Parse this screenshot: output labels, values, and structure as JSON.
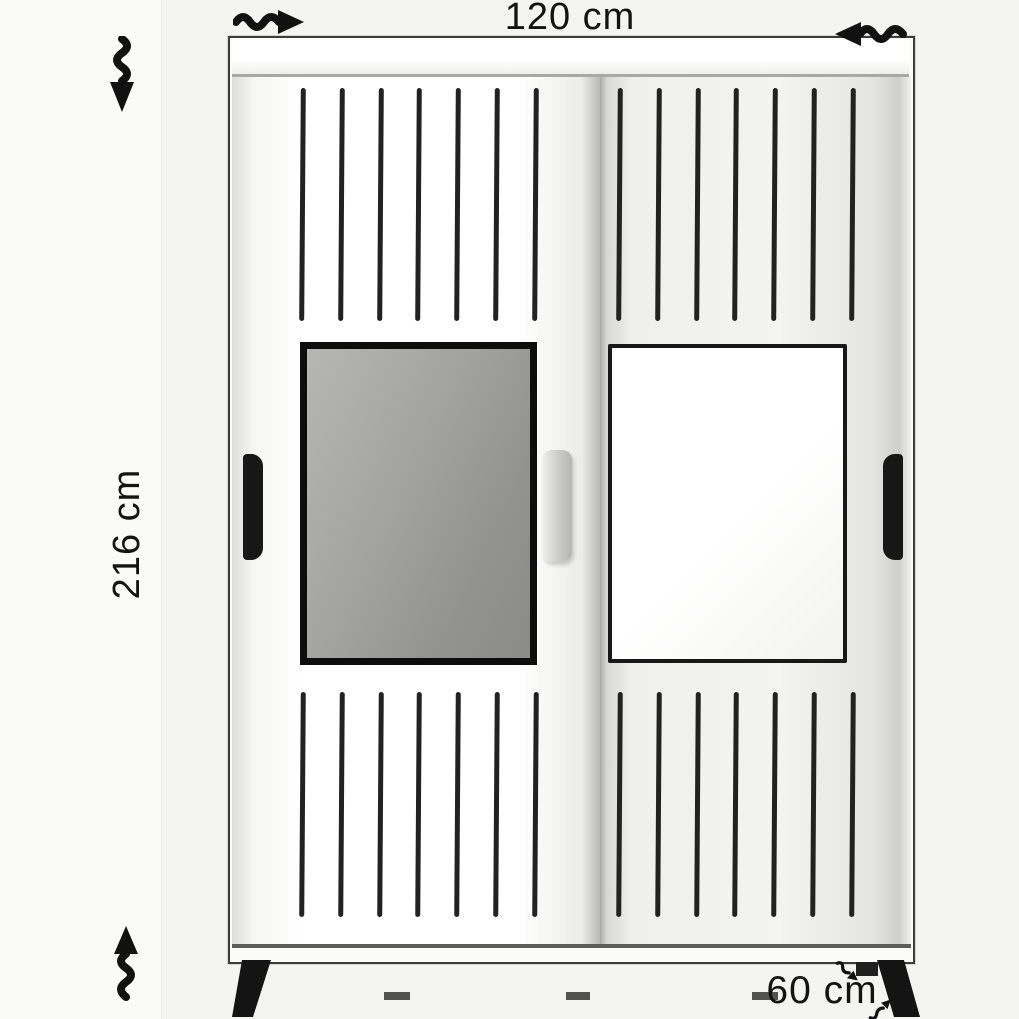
{
  "dimension_labels": {
    "width": "120 cm",
    "height": "216 cm",
    "depth": "60 cm"
  },
  "icons": {
    "width_arrow_right": "wavy-arrow-pointing-right",
    "width_arrow_left": "wavy-arrow-pointing-left",
    "height_arrow_down": "wavy-arrow-pointing-down",
    "height_arrow_up": "wavy-arrow-pointing-up",
    "depth_arrow_down": "small-wavy-arrow-pointing-down-right",
    "depth_arrow_up": "small-wavy-arrow-pointing-up-right"
  },
  "furniture": {
    "kind": "two-sliding-door-wardrobe",
    "slats_per_section": 7,
    "slat_sections": [
      "left-top",
      "right-top",
      "left-bottom",
      "right-bottom"
    ],
    "panels": [
      "mirror-left-door",
      "outlined-panel-right-door"
    ]
  },
  "colors": {
    "background": "#f4f4f3",
    "outline": "#3c3c3c",
    "slat": "#222222",
    "mirror_fill": "#9a9a98",
    "plinth": "#8e8e8d",
    "annotation": "#131313"
  }
}
